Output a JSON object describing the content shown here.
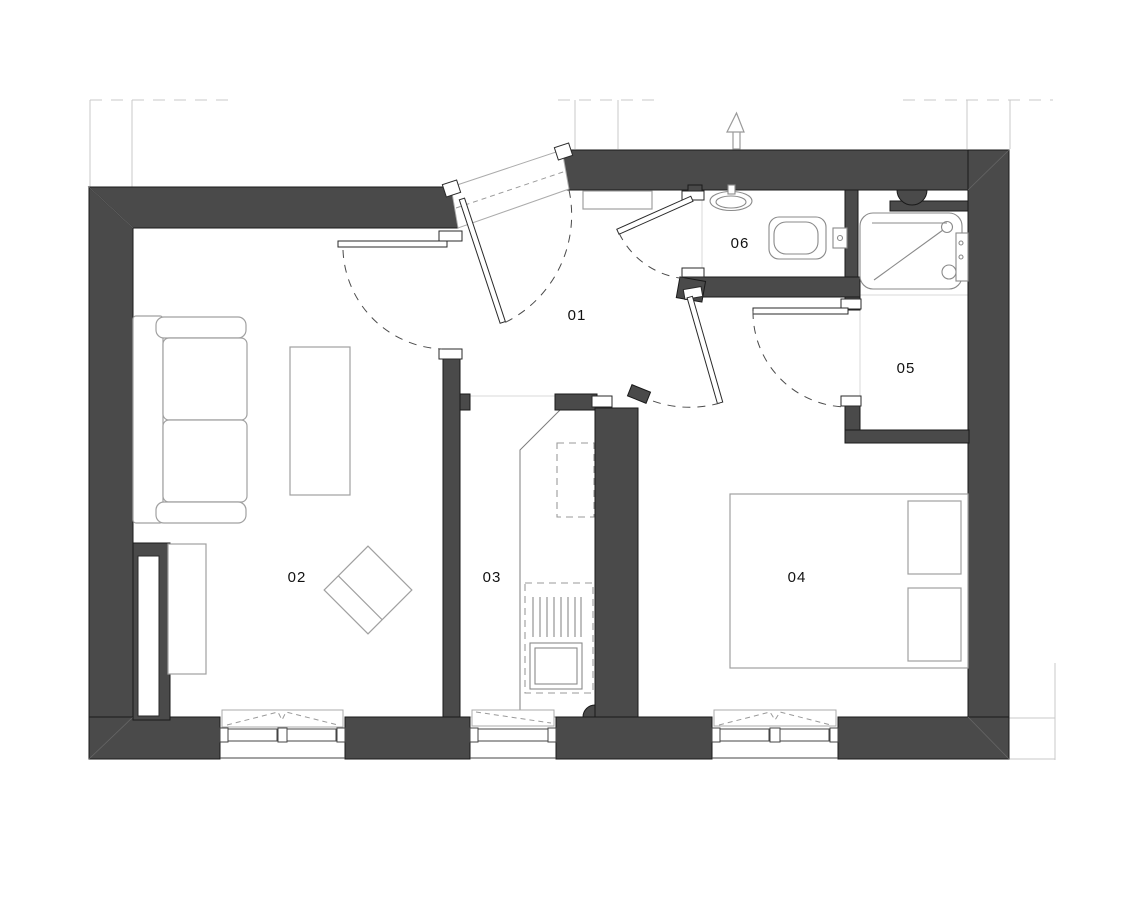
{
  "drawing": {
    "type": "architectural floor plan",
    "rooms": [
      {
        "number": "01",
        "role": "hallway"
      },
      {
        "number": "02",
        "role": "living-room"
      },
      {
        "number": "03",
        "role": "kitchen"
      },
      {
        "number": "04",
        "role": "bedroom"
      },
      {
        "number": "05",
        "role": "shower-room"
      },
      {
        "number": "06",
        "role": "wc"
      }
    ],
    "icons": [
      {
        "name": "north-arrow-icon"
      }
    ],
    "colors": {
      "background": "#ffffff",
      "wall_fill": "#4a4a4a",
      "wall_outline": "#1a1a1a",
      "tile_grid_line": "#d8d8d8",
      "furniture_line": "#a0a0a0",
      "fixture_line": "#8a8a8a",
      "door_swing_arc": "#4a4a4a",
      "reference_line": "#c9c9c9",
      "label_text": "#111111"
    }
  }
}
